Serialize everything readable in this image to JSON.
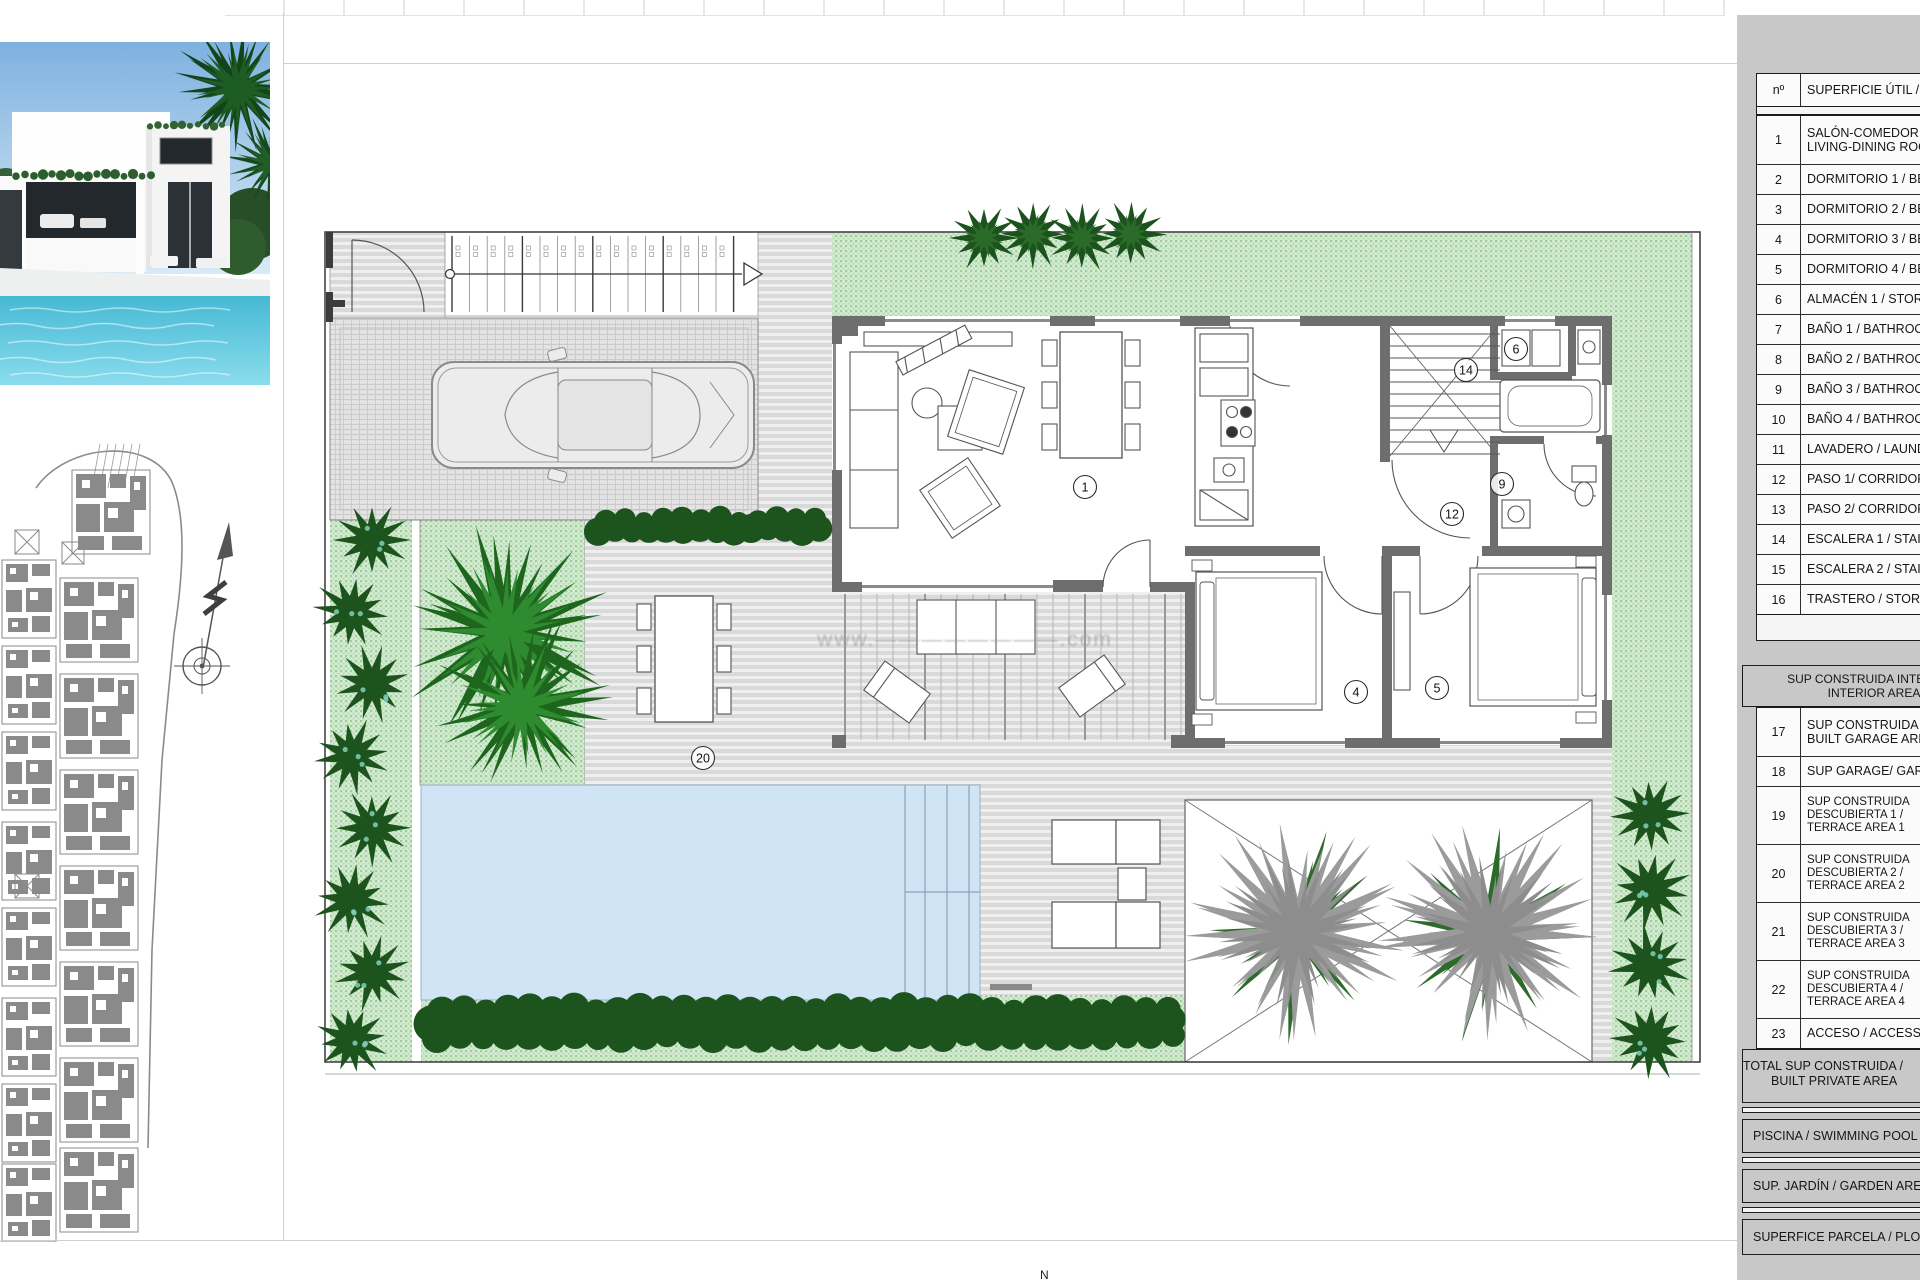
{
  "sheet": {
    "watermark": "www.————————.com",
    "bottom_edge_mark": "N"
  },
  "area_table": {
    "header": {
      "no": "nº",
      "label": "SUPERFICIE ÚTIL / USABLE AREA"
    },
    "rows": [
      {
        "no": "1",
        "lines": [
          "SALÓN-COMEDOR /",
          "LIVING-DINING ROOM"
        ]
      },
      {
        "no": "2",
        "lines": [
          "DORMITORIO 1 / BEDROOM 1"
        ]
      },
      {
        "no": "3",
        "lines": [
          "DORMITORIO 2 / BEDROOM 2"
        ]
      },
      {
        "no": "4",
        "lines": [
          "DORMITORIO 3 / BEDROOM 3"
        ]
      },
      {
        "no": "5",
        "lines": [
          "DORMITORIO 4 / BEDROOM 4"
        ]
      },
      {
        "no": "6",
        "lines": [
          "ALMACÉN 1 / STORAGE 1"
        ]
      },
      {
        "no": "7",
        "lines": [
          "BAÑO 1 / BATHROOM 1"
        ]
      },
      {
        "no": "8",
        "lines": [
          "BAÑO 2 / BATHROOM 2"
        ]
      },
      {
        "no": "9",
        "lines": [
          "BAÑO 3 / BATHROOM 3"
        ]
      },
      {
        "no": "10",
        "lines": [
          "BAÑO 4 / BATHROOM 4"
        ]
      },
      {
        "no": "11",
        "lines": [
          "LAVADERO / LAUNDRY"
        ]
      },
      {
        "no": "12",
        "lines": [
          "PASO 1/ CORRIDOR 1"
        ]
      },
      {
        "no": "13",
        "lines": [
          "PASO 2/ CORRIDOR 2"
        ]
      },
      {
        "no": "14",
        "lines": [
          "ESCALERA 1 / STAIRS 1"
        ]
      },
      {
        "no": "15",
        "lines": [
          "ESCALERA 2 / STAIRS 2"
        ]
      },
      {
        "no": "16",
        "lines": [
          "TRASTERO / STORAGE"
        ]
      }
    ],
    "section_header_lines": [
      "SUP CONSTRUIDA INTERIOR /",
      "INTERIOR AREA"
    ],
    "rows2": [
      {
        "no": "17",
        "lines": [
          "SUP CONSTRUIDA GARAJE /",
          "BUILT GARAGE AREA"
        ]
      },
      {
        "no": "18",
        "lines": [
          "SUP GARAGE/ GARAGE"
        ]
      },
      {
        "no": "19",
        "lines": [
          "SUP CONSTRUIDA",
          "DESCUBIERTA 1 /",
          "TERRACE AREA 1"
        ]
      },
      {
        "no": "20",
        "lines": [
          "SUP CONSTRUIDA",
          "DESCUBIERTA 2 /",
          "TERRACE AREA 2"
        ]
      },
      {
        "no": "21",
        "lines": [
          "SUP CONSTRUIDA",
          "DESCUBIERTA 3 /",
          "TERRACE AREA 3"
        ]
      },
      {
        "no": "22",
        "lines": [
          "SUP CONSTRUIDA",
          "DESCUBIERTA 4 /",
          "TERRACE AREA 4"
        ]
      },
      {
        "no": "23",
        "lines": [
          "ACCESO / ACCESS"
        ]
      }
    ],
    "total_lines": [
      "TOTAL SUP CONSTRUIDA /",
      "BUILT PRIVATE AREA"
    ],
    "summary_rows": [
      "PISCINA / SWIMMING POOL",
      "SUP. JARDÍN / GARDEN AREA",
      "SUPERFICE PARCELA / PLOT AREA"
    ]
  },
  "plan": {
    "room_labels": [
      {
        "n": "1",
        "x": 1085,
        "y": 487
      },
      {
        "n": "6",
        "x": 1516,
        "y": 349
      },
      {
        "n": "14",
        "x": 1466,
        "y": 370
      },
      {
        "n": "9",
        "x": 1502,
        "y": 484
      },
      {
        "n": "12",
        "x": 1452,
        "y": 514
      },
      {
        "n": "4",
        "x": 1356,
        "y": 692
      },
      {
        "n": "5",
        "x": 1437,
        "y": 688
      },
      {
        "n": "20",
        "x": 703,
        "y": 758
      }
    ]
  },
  "colors": {
    "panel_gray": "#c8c8c8",
    "garden_green": "#d5ebd3",
    "garden_dot": "#9ecd9c",
    "foliage_dark": "#1d531d",
    "palm_green": "#1e651e",
    "palm_gray": "#9b9b9b",
    "pool_blue": "#cfe4f4",
    "wall_gray": "#6e6e6e"
  }
}
